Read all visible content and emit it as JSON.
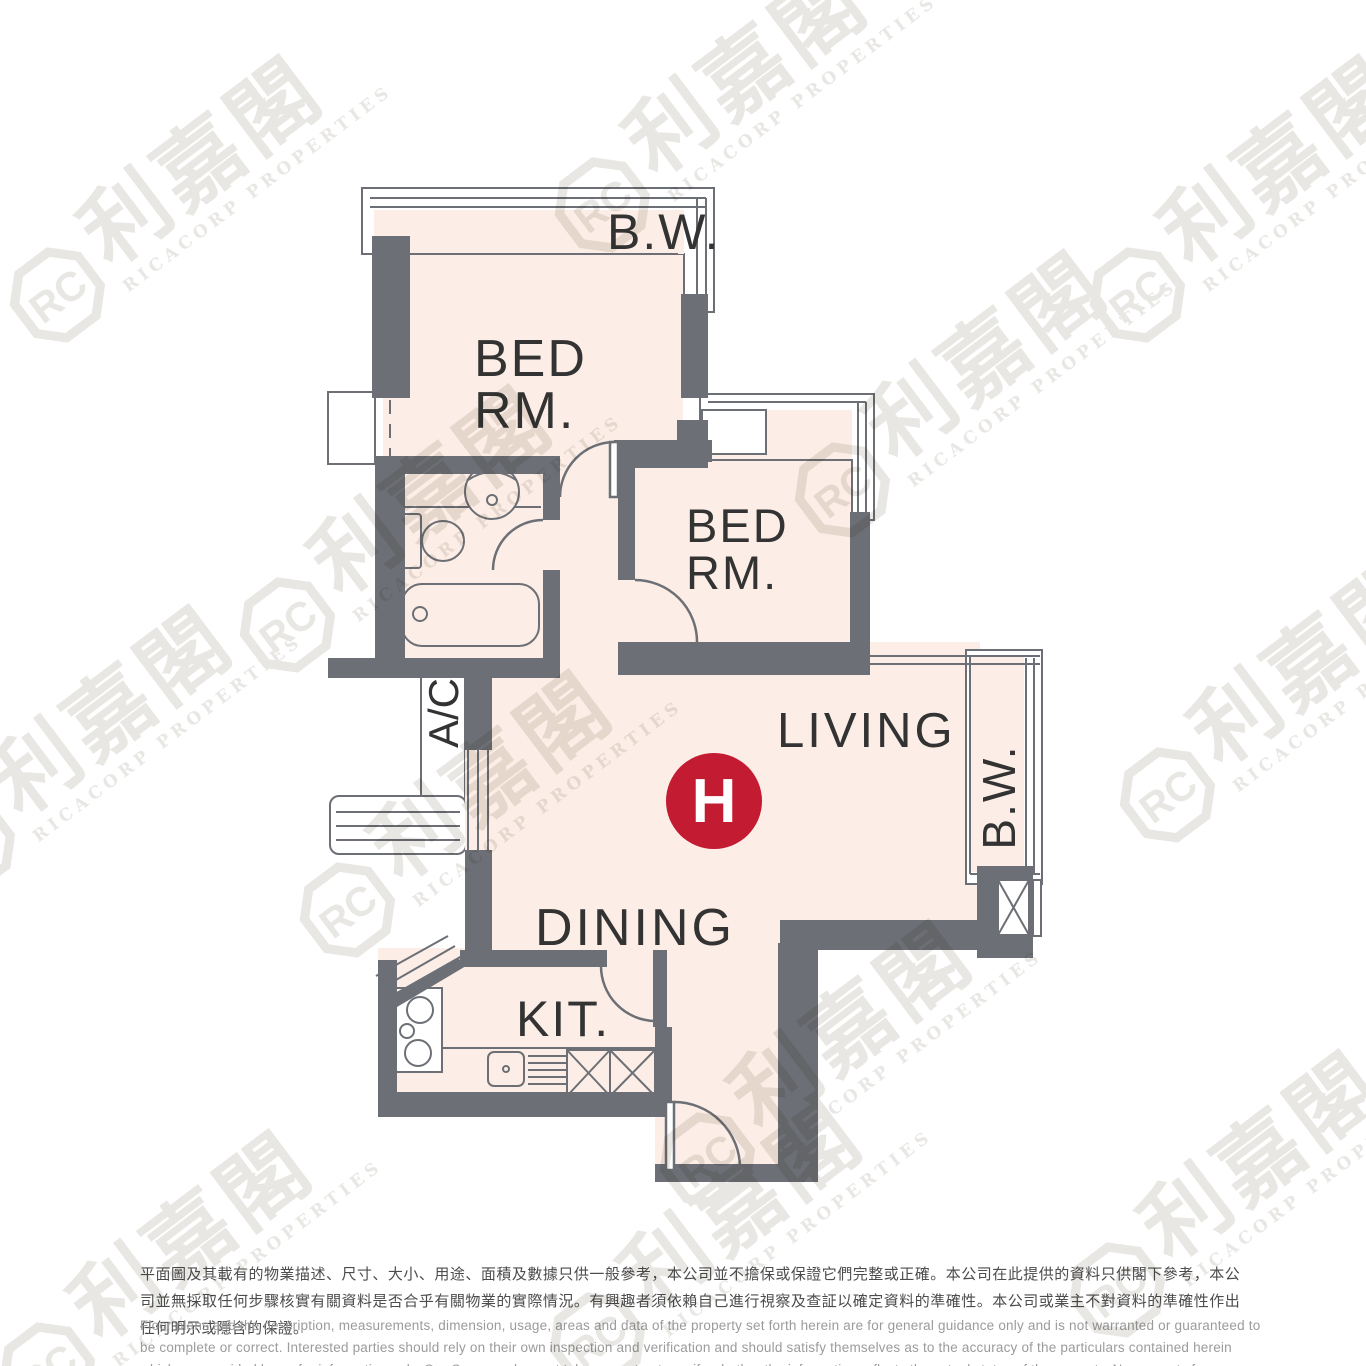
{
  "floor_plan": {
    "unit_badge": {
      "label": "H"
    },
    "rooms": {
      "bedroom1": {
        "line1": "BED",
        "line2": "RM."
      },
      "bedroom2": {
        "line1": "BED",
        "line2": "RM."
      },
      "living": {
        "label": "LIVING"
      },
      "dining": {
        "label": "DINING"
      },
      "kitchen": {
        "label": "KIT."
      },
      "bay_window_top": {
        "label": "B.W."
      },
      "bay_window_right": {
        "label": "B.W."
      },
      "ac_platform": {
        "label": "A/C"
      }
    },
    "colors": {
      "wall": "#6c6f75",
      "room_fill": "#fceee6",
      "badge_red": "#c31b31",
      "label_text": "#333333"
    }
  },
  "watermark": {
    "logo": "RC",
    "chinese": "利嘉閣",
    "english": "RICACORP PROPERTIES"
  },
  "disclaimer": {
    "chinese": "平面圖及其載有的物業描述、尺寸、大小、用途、面積及數據只供一般參考，本公司並不擔保或保證它們完整或正確。本公司在此提供的資料只供閣下參考，本公司並無採取任何步驟核實有關資料是否合乎有關物業的實際情況。有興趣者須依賴自己進行視察及查証以確定資料的準確性。本公司或業主不對資料的準確性作出任何明示或隱含的保證。",
    "english": "Floor plans and the description, measurements, dimension, usage, areas and data of the property set forth herein are for general guidance only and is not warranted or guaranteed to be complete or correct.  Interested parties should rely on their own inspection and verification and should satisfy themselves as to the accuracy of the particulars contained herein which are provided by us for information only.  Our Company has not taken any step to verify whether the information reflects the actual status of the property.  No warranty for accuracy is given or implied by the owners or us."
  }
}
